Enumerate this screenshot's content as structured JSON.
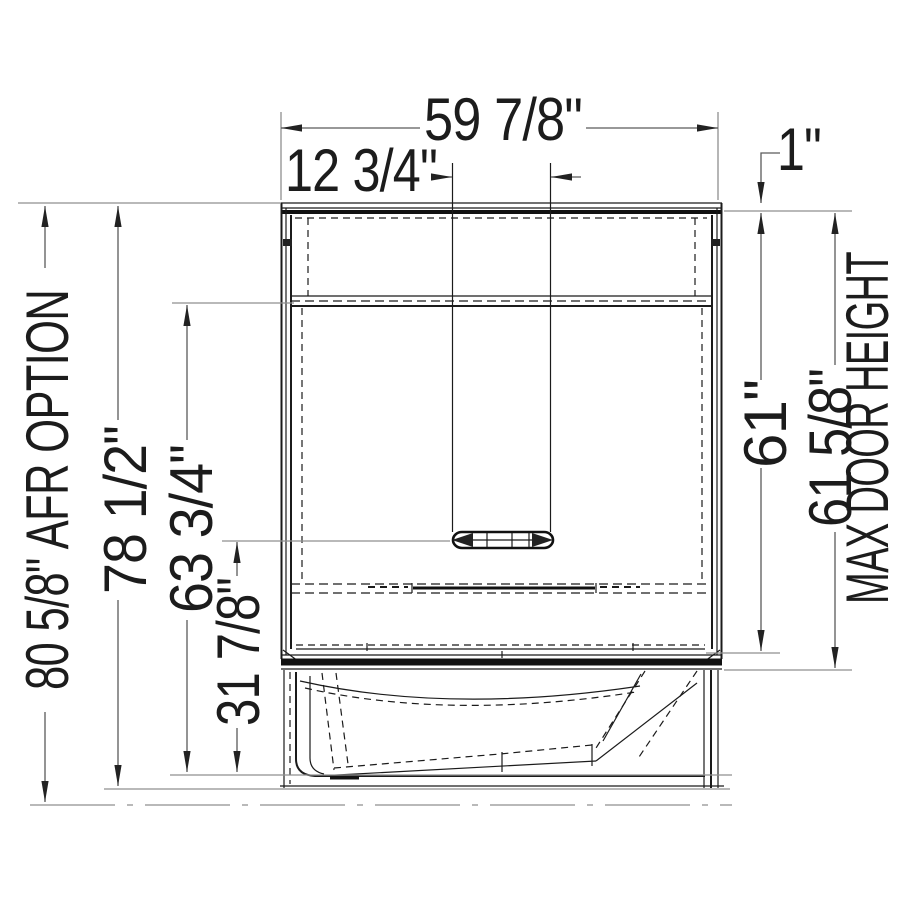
{
  "dims": {
    "overall_width": "59 7/8\"",
    "center_spacing": "12 3/4\"",
    "flange_offset": "1\"",
    "afr_option_height": "80 5/8\" AFR OPTION",
    "overall_height": "78 1/2\"",
    "wall_top_height": "63 3/4\"",
    "ledge_height": "31 7/8\"",
    "wall_height": "61\"",
    "max_door_height": "61 5/8\"",
    "max_door_height_label": "MAX DOOR HEIGHT"
  },
  "drawing": {
    "line_color": "#1b1b1b",
    "dimension_color": "#5a5a5a",
    "background": "#ffffff"
  }
}
